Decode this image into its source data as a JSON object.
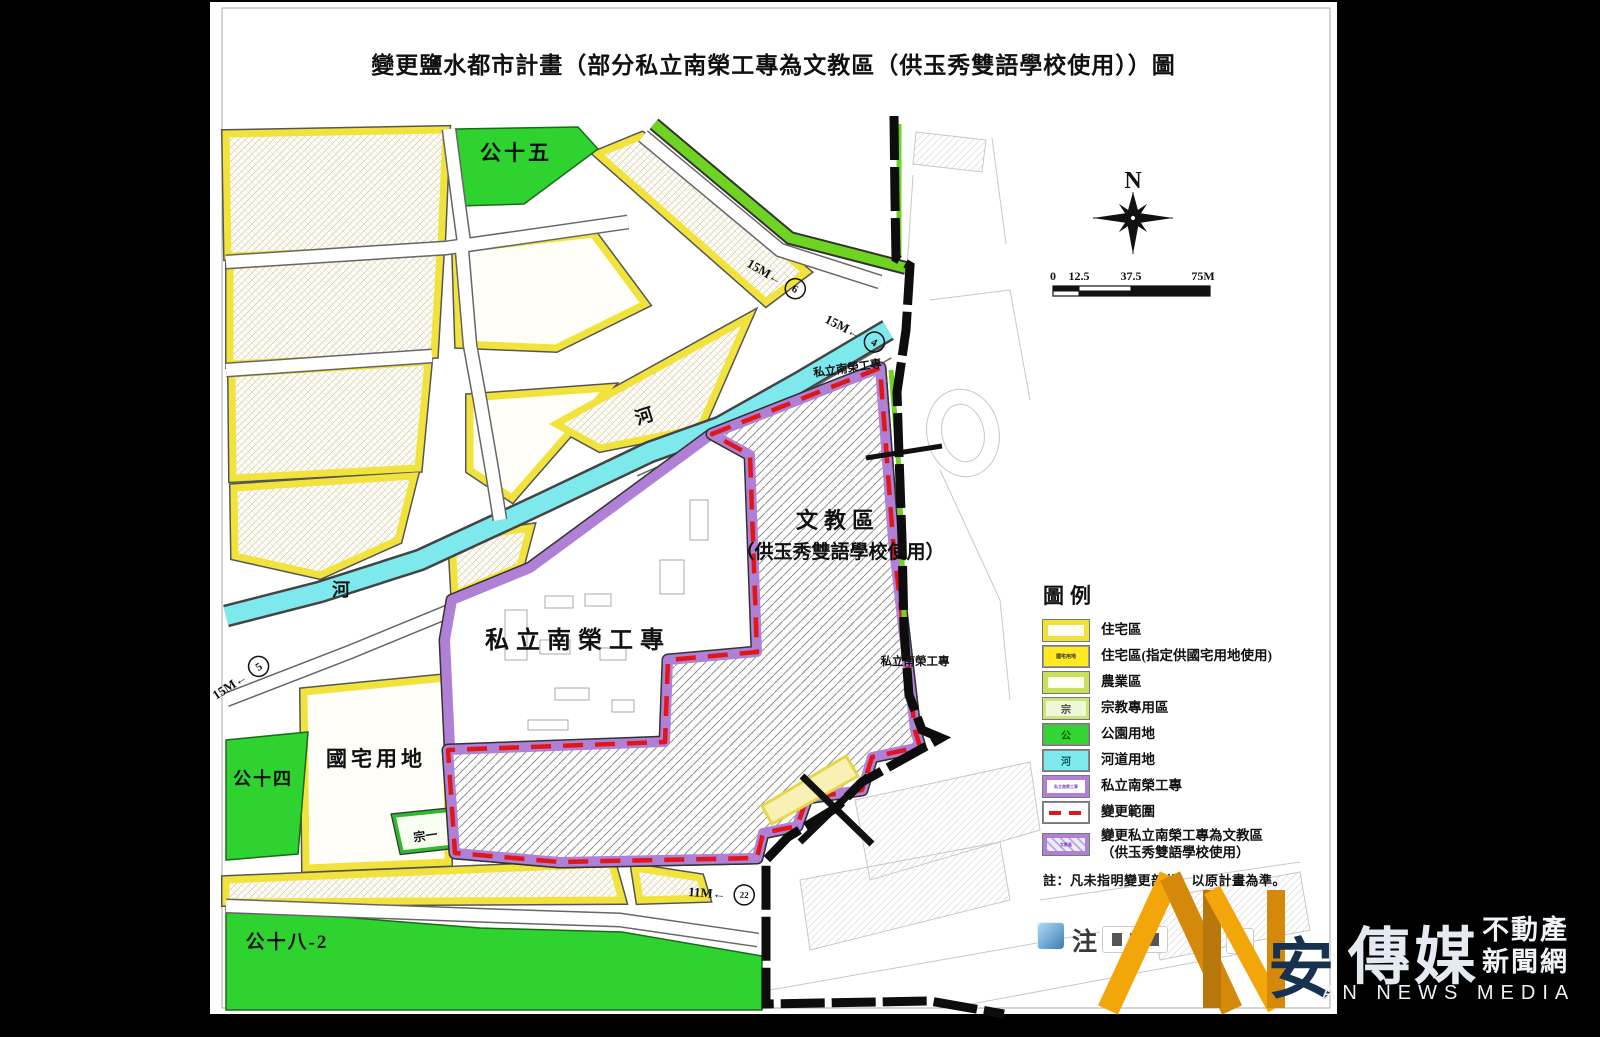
{
  "title": "變更鹽水都市計畫（部分私立南榮工專為文教區（供玉秀雙語學校使用））圖",
  "map": {
    "areas": {
      "park15": "公十五",
      "park14": "公十四",
      "park18_2": "公十八-2",
      "river1": "河",
      "river2": "河",
      "school_main": "私立南榮工專",
      "school_small_top": "私立南榮工專",
      "school_small_right": "私立南榮工專",
      "culture_zone_line1": "文教區",
      "culture_zone_line2": "（供玉秀雙語學校使用）",
      "public_housing": "國宅用地",
      "religious1": "宗一"
    },
    "roads": {
      "r6": {
        "label": "15M←",
        "num": "6"
      },
      "r4": {
        "label": "15M←",
        "num": "4"
      },
      "r5": {
        "label": "15M←",
        "num": "5"
      },
      "r22": {
        "label": "11M←",
        "num": "22"
      }
    },
    "compass": "N",
    "scalebar": {
      "t0": "0",
      "t1": "12.5",
      "t2": "37.5",
      "t3": "75M"
    }
  },
  "legend": {
    "title": "圖例",
    "items": [
      {
        "label": "住宅區"
      },
      {
        "label": "住宅區(指定供國宅用地使用)",
        "swatch_text": "國宅用地"
      },
      {
        "label": "農業區"
      },
      {
        "label": "宗教專用區",
        "swatch_text": "宗"
      },
      {
        "label": "公園用地",
        "swatch_text": "公"
      },
      {
        "label": "河道用地",
        "swatch_text": "河"
      },
      {
        "label": "私立南榮工專",
        "swatch_text": "私立南榮工專"
      },
      {
        "label": "變更範圍"
      },
      {
        "label": "變更私立南榮工專為文教區",
        "label2": "（供玉秀雙語學校使用）",
        "swatch_text": "文教區"
      }
    ],
    "note": "註：凡未指明變更部分，以原計畫為準。"
  },
  "watermark": {
    "note_char": "注",
    "brand_first": "安",
    "brand_rest": "傳媒",
    "tag_line1": "不動產",
    "tag_line2": "新聞網",
    "subtitle": "AN NEWS MEDIA"
  },
  "colors": {
    "residential_yellow": "#f2e33c",
    "park_green": "#2fd32f",
    "river_cyan": "#7de9ec",
    "school_purple": "#b07fd6",
    "change_red": "#e11616",
    "road_green_edge": "#6fd421",
    "boundary_black": "#0d0d0d",
    "logo_orange": "#f2a60a",
    "logo_navy": "#16324f"
  }
}
